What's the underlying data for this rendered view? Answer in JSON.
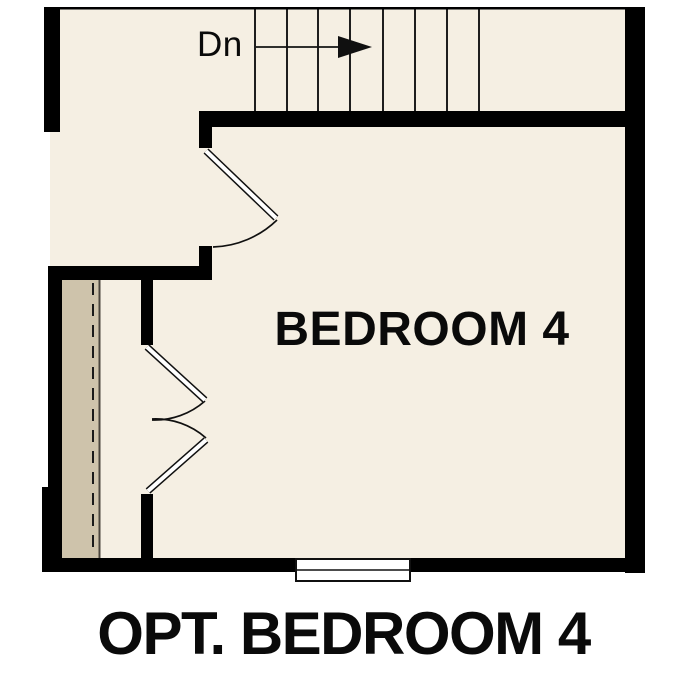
{
  "labels": {
    "stairs_direction": "Dn",
    "room": "BEDROOM 4",
    "caption": "OPT. BEDROOM 4"
  },
  "icons": {
    "stairs_arrow": "right-arrow"
  },
  "colors": {
    "background": "#ffffff",
    "floor": "#f5efe3",
    "closet_floor": "#cec3ab",
    "wall": "#000000",
    "line": "#1e1e1e",
    "text": "#0a0a0a"
  },
  "plan": {
    "rooms": [
      {
        "label": "BEDROOM 4"
      }
    ],
    "stairs": {
      "label": "Dn",
      "treads_visible": 8
    },
    "doors": {
      "entry_swing_door": 1,
      "closet_double_doors": 2
    },
    "windows_visible": 1,
    "closet": {
      "rod_style": "dashed-line",
      "shelf_edge_style": "solid-line"
    }
  }
}
